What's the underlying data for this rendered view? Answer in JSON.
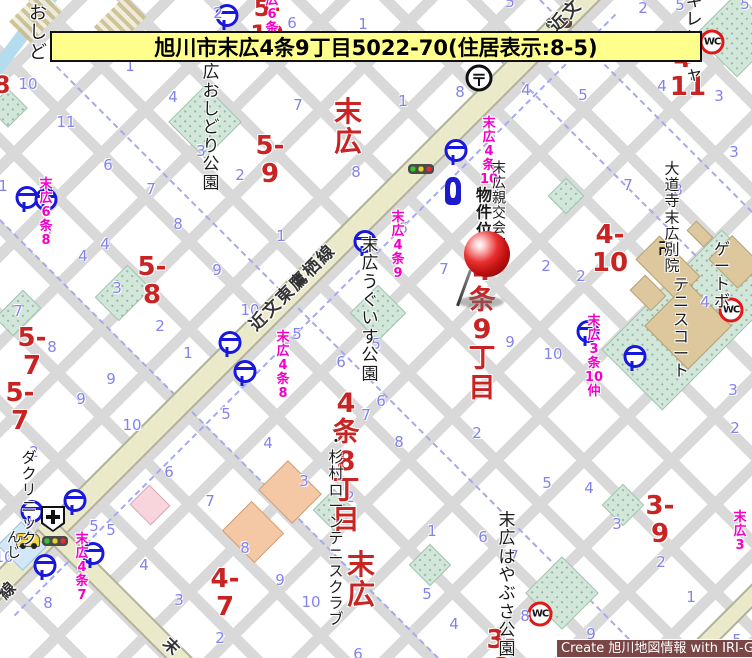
{
  "banner": {
    "title": "旭川市末広4条9丁目5022-70(住居表示:8-5)"
  },
  "attribution": {
    "text": "Create 旭川地図情報 with IRI-GO"
  },
  "colors": {
    "banner_bg": "#ffff8c",
    "district_red": "#c82424",
    "busstop_magenta": "#f500c8",
    "block_number_blue": "#8383ee",
    "main_road": "#eaeacb",
    "park_green": "#d2e7da",
    "bus_icon_blue": "#1818dd",
    "wc_ring_red": "#e01818",
    "attribution_bg": "#7a4646",
    "pin_red": "#c01010"
  },
  "pin": {
    "label": "物件位置",
    "ball_cx": 487,
    "ball_cy": 254,
    "needle_cx": 464,
    "needle_cy": 288,
    "shadow_cx": 481,
    "shadow_cy": 302
  },
  "roads": [
    {
      "n": "road-kinbun-higashitakasu",
      "cx": 292,
      "cy": 292,
      "len": 880,
      "w": 24,
      "rot": -45
    },
    {
      "n": "road-branch-south",
      "cx": 118,
      "cy": 597,
      "len": 210,
      "w": 20,
      "rot": 45
    },
    {
      "n": "road-bottom-right",
      "cx": 720,
      "cy": 628,
      "len": 130,
      "w": 18,
      "rot": -45
    }
  ],
  "water": [
    {
      "n": "river",
      "cx": 25,
      "cy": 32,
      "len": 100,
      "w": 13,
      "rot": -53
    }
  ],
  "hatches": [
    {
      "cx": 36,
      "cy": 16,
      "w": 30,
      "h": 46,
      "rot": 45
    },
    {
      "cx": 120,
      "cy": 22,
      "w": 30,
      "h": 44,
      "rot": 45
    }
  ],
  "dashes": [
    {
      "cx": 350,
      "cy": 360,
      "len": 830,
      "rot": 45
    },
    {
      "cx": 616,
      "cy": 176,
      "len": 385,
      "rot": 45
    },
    {
      "cx": 219,
      "cy": 439,
      "len": 620,
      "rot": 45
    },
    {
      "cx": 646,
      "cy": 106,
      "len": 300,
      "rot": 45
    },
    {
      "cx": 315,
      "cy": 315,
      "len": 850,
      "rot": -45
    }
  ],
  "parks": [
    {
      "n": "park-oshidori",
      "cx": 205,
      "cy": 122,
      "w": 52,
      "h": 52
    },
    {
      "n": "park-uguisu",
      "cx": 378,
      "cy": 313,
      "w": 40,
      "h": 40
    },
    {
      "n": "park-hayabusa",
      "cx": 562,
      "cy": 593,
      "w": 52,
      "h": 52
    },
    {
      "n": "park-kirenja",
      "cx": 737,
      "cy": 35,
      "w": 60,
      "h": 60
    },
    {
      "n": "tennis-court-area",
      "cx": 692,
      "cy": 320,
      "w": 86,
      "h": 170
    },
    {
      "n": "green-block",
      "cx": 18,
      "cy": 313,
      "w": 26,
      "h": 40
    },
    {
      "n": "green-block",
      "cx": 123,
      "cy": 293,
      "w": 34,
      "h": 46
    },
    {
      "n": "green-block",
      "cx": 334,
      "cy": 510,
      "w": 30,
      "h": 30
    },
    {
      "n": "green-block",
      "cx": 430,
      "cy": 565,
      "w": 30,
      "h": 30
    },
    {
      "n": "green-block",
      "cx": 623,
      "cy": 505,
      "w": 30,
      "h": 30
    },
    {
      "n": "green-block",
      "cx": 566,
      "cy": 196,
      "w": 26,
      "h": 26
    },
    {
      "n": "green-block",
      "cx": 8,
      "cy": 108,
      "w": 28,
      "h": 28
    }
  ],
  "buildings": [
    {
      "n": "temple-building",
      "cx": 668,
      "cy": 268,
      "w": 58,
      "h": 34,
      "c": "tan"
    },
    {
      "n": "temple-building",
      "cx": 648,
      "cy": 293,
      "w": 30,
      "h": 22,
      "c": "tan"
    },
    {
      "n": "building",
      "cx": 700,
      "cy": 234,
      "w": 24,
      "h": 14,
      "c": "tan"
    },
    {
      "n": "tennis-court",
      "cx": 688,
      "cy": 326,
      "w": 62,
      "h": 62,
      "c": "tan"
    },
    {
      "n": "tennis-court",
      "cx": 735,
      "cy": 262,
      "w": 42,
      "h": 34,
      "c": "tan"
    },
    {
      "n": "building",
      "cx": 290,
      "cy": 492,
      "w": 48,
      "h": 42,
      "c": "orange"
    },
    {
      "n": "building",
      "cx": 253,
      "cy": 532,
      "w": 46,
      "h": 42,
      "c": "orange"
    },
    {
      "n": "clinic-building",
      "cx": 150,
      "cy": 505,
      "w": 30,
      "h": 28,
      "c": "pink"
    },
    {
      "n": "building",
      "cx": 22,
      "cy": 546,
      "w": 36,
      "h": 34,
      "c": "lblue"
    }
  ],
  "icons": [
    {
      "k": "bus",
      "x": 224,
      "y": 17
    },
    {
      "k": "bus",
      "x": 24,
      "y": 199
    },
    {
      "k": "bus",
      "x": 43,
      "y": 201
    },
    {
      "k": "bus",
      "x": 453,
      "y": 152
    },
    {
      "k": "bus",
      "x": 362,
      "y": 243
    },
    {
      "k": "bus",
      "x": 227,
      "y": 344
    },
    {
      "k": "bus",
      "x": 242,
      "y": 373
    },
    {
      "k": "bus",
      "x": 585,
      "y": 333
    },
    {
      "k": "bus",
      "x": 632,
      "y": 358
    },
    {
      "k": "bus",
      "x": 72,
      "y": 502
    },
    {
      "k": "bus",
      "x": 29,
      "y": 513
    },
    {
      "k": "bus",
      "x": 90,
      "y": 555
    },
    {
      "k": "bus",
      "x": 42,
      "y": 567
    },
    {
      "k": "tl",
      "x": 421,
      "y": 169
    },
    {
      "k": "tl",
      "x": 559,
      "y": 23
    },
    {
      "k": "tl",
      "x": 55,
      "y": 541
    },
    {
      "k": "wc",
      "x": 712,
      "y": 42,
      "t": "WC"
    },
    {
      "k": "wc",
      "x": 731,
      "y": 310,
      "t": "WC"
    },
    {
      "k": "wc",
      "x": 540,
      "y": 614,
      "t": "WC"
    },
    {
      "k": "post",
      "x": 479,
      "y": 78,
      "t": "〒"
    },
    {
      "k": "hosp",
      "x": 53,
      "y": 519
    },
    {
      "k": "temple",
      "x": 666,
      "y": 247,
      "t": "卍"
    },
    {
      "k": "monu",
      "x": 453,
      "y": 191
    },
    {
      "k": "reddot",
      "x": 555,
      "y": 50
    },
    {
      "k": "car",
      "x": 28,
      "y": 540
    }
  ],
  "labels": {
    "red": [
      {
        "text": "5-10",
        "x": 267,
        "y": 22,
        "size": 24
      },
      {
        "text": "8",
        "x": 2,
        "y": 86,
        "size": 24
      },
      {
        "text": "4-11",
        "x": 688,
        "y": 73,
        "size": 26
      },
      {
        "text": "5-9",
        "x": 270,
        "y": 160,
        "size": 26
      },
      {
        "text": "末広",
        "x": 348,
        "y": 127,
        "size": 28
      },
      {
        "text": "4-10",
        "x": 610,
        "y": 249,
        "size": 26
      },
      {
        "text": "4条9丁目",
        "x": 482,
        "y": 330,
        "size": 27
      },
      {
        "text": "5-8",
        "x": 152,
        "y": 281,
        "size": 26
      },
      {
        "text": "5-7",
        "x": 32,
        "y": 352,
        "size": 26
      },
      {
        "text": "5-7",
        "x": 20,
        "y": 407,
        "size": 26
      },
      {
        "text": "4条8丁目",
        "x": 346,
        "y": 462,
        "size": 27
      },
      {
        "text": "4-7",
        "x": 225,
        "y": 593,
        "size": 26
      },
      {
        "text": "末広",
        "x": 361,
        "y": 580,
        "size": 28
      },
      {
        "text": "3-9",
        "x": 660,
        "y": 520,
        "size": 26
      },
      {
        "text": "3-8",
        "x": 501,
        "y": 654,
        "size": 26
      }
    ],
    "magenta": [
      {
        "text": "末広6条10",
        "x": 272,
        "y": 15
      },
      {
        "text": "末広6条8",
        "x": 46,
        "y": 213
      },
      {
        "text": "末広4条10",
        "x": 489,
        "y": 152
      },
      {
        "text": "末広4条9",
        "x": 398,
        "y": 246
      },
      {
        "text": "末広4条8",
        "x": 283,
        "y": 366
      },
      {
        "text": "末広3条\n10仲",
        "x": 594,
        "y": 357
      },
      {
        "text": "末広4条7",
        "x": 82,
        "y": 568
      },
      {
        "text": "末広3",
        "x": 740,
        "y": 532
      }
    ],
    "black": [
      {
        "text": "おしど",
        "x": 38,
        "y": 33,
        "size": 18
      },
      {
        "text": "末広\nおしどり公園",
        "x": 211,
        "y": 119,
        "size": 17
      },
      {
        "text": "末広キレンジャ",
        "x": 694,
        "y": 20,
        "size": 17
      },
      {
        "text": "末広親交会館",
        "x": 499,
        "y": 207,
        "size": 14
      },
      {
        "text": "物件位置",
        "x": 484,
        "y": 221,
        "size": 16,
        "b": 1,
        "n": "property-location-label"
      },
      {
        "text": "大道寺\n末広別院",
        "x": 672,
        "y": 217,
        "size": 15
      },
      {
        "text": "ゲートボ",
        "x": 722,
        "y": 275,
        "size": 16
      },
      {
        "text": "テニスコート",
        "x": 681,
        "y": 328,
        "size": 16
      },
      {
        "text": "末広\nうぐいす公園",
        "x": 370,
        "y": 310,
        "size": 17
      },
      {
        "text": "・杉村ローンテニスクラブ",
        "x": 336,
        "y": 530,
        "size": 15
      },
      {
        "text": "末広\nはやぶさ公園",
        "x": 507,
        "y": 585,
        "size": 17
      },
      {
        "text": "んじ",
        "x": 14,
        "y": 546,
        "size": 14
      },
      {
        "text": "ダクリニック",
        "x": 29,
        "y": 498,
        "size": 15
      }
    ],
    "rotated": [
      {
        "text": "近文東鷹栖線",
        "x": 293,
        "y": 288,
        "size": 17,
        "rot": -45,
        "n": "road-name-label"
      },
      {
        "text": "近文",
        "x": 566,
        "y": 16,
        "size": 17,
        "rot": -45,
        "n": "road-name-label"
      },
      {
        "text": "線",
        "x": 8,
        "y": 590,
        "size": 16,
        "rot": -45,
        "n": "road-name-label"
      },
      {
        "text": "末",
        "x": 172,
        "y": 647,
        "size": 16,
        "rot": 45,
        "n": "road-name-label"
      }
    ],
    "blue_numbers": [
      {
        "t": "5",
        "x": 263,
        "y": 3
      },
      {
        "t": "2",
        "x": 218,
        "y": 13
      },
      {
        "t": "6",
        "x": 292,
        "y": 23
      },
      {
        "t": "1",
        "x": 363,
        "y": 24
      },
      {
        "t": "5",
        "x": 510,
        "y": 2
      },
      {
        "t": "2",
        "x": 643,
        "y": 8
      },
      {
        "t": "5",
        "x": 680,
        "y": 5
      },
      {
        "t": "5",
        "x": 745,
        "y": 4
      },
      {
        "t": "1",
        "x": 130,
        "y": 66
      },
      {
        "t": "10",
        "x": 28,
        "y": 84
      },
      {
        "t": "11",
        "x": 66,
        "y": 122
      },
      {
        "t": "4",
        "x": 173,
        "y": 97
      },
      {
        "t": "3",
        "x": 201,
        "y": 151
      },
      {
        "t": "2",
        "x": 240,
        "y": 175
      },
      {
        "t": "6",
        "x": 108,
        "y": 165
      },
      {
        "t": "7",
        "x": 151,
        "y": 189
      },
      {
        "t": "8",
        "x": 178,
        "y": 224
      },
      {
        "t": "5",
        "x": 47,
        "y": 231
      },
      {
        "t": "1",
        "x": 3,
        "y": 186
      },
      {
        "t": "4",
        "x": 105,
        "y": 244
      },
      {
        "t": "4",
        "x": 83,
        "y": 256
      },
      {
        "t": "7",
        "x": 298,
        "y": 105
      },
      {
        "t": "1",
        "x": 403,
        "y": 101
      },
      {
        "t": "8",
        "x": 356,
        "y": 172
      },
      {
        "t": "8",
        "x": 460,
        "y": 92
      },
      {
        "t": "4",
        "x": 526,
        "y": 90
      },
      {
        "t": "5",
        "x": 583,
        "y": 95
      },
      {
        "t": "4",
        "x": 662,
        "y": 86
      },
      {
        "t": "3",
        "x": 719,
        "y": 96
      },
      {
        "t": "3",
        "x": 495,
        "y": 192
      },
      {
        "t": "7",
        "x": 628,
        "y": 185
      },
      {
        "t": "8",
        "x": 678,
        "y": 190
      },
      {
        "t": "2",
        "x": 546,
        "y": 266
      },
      {
        "t": "2",
        "x": 581,
        "y": 276
      },
      {
        "t": "7",
        "x": 444,
        "y": 269
      },
      {
        "t": "6",
        "x": 403,
        "y": 228
      },
      {
        "t": "1",
        "x": 281,
        "y": 236
      },
      {
        "t": "9",
        "x": 217,
        "y": 270
      },
      {
        "t": "10",
        "x": 250,
        "y": 310
      },
      {
        "t": "5",
        "x": 297,
        "y": 334
      },
      {
        "t": "6",
        "x": 341,
        "y": 362
      },
      {
        "t": "5",
        "x": 376,
        "y": 344
      },
      {
        "t": "6",
        "x": 381,
        "y": 401
      },
      {
        "t": "1",
        "x": 188,
        "y": 353
      },
      {
        "t": "5",
        "x": 226,
        "y": 414
      },
      {
        "t": "7",
        "x": 366,
        "y": 415
      },
      {
        "t": "9",
        "x": 510,
        "y": 342
      },
      {
        "t": "10",
        "x": 553,
        "y": 354
      },
      {
        "t": "7",
        "x": 18,
        "y": 311
      },
      {
        "t": "3",
        "x": 117,
        "y": 288
      },
      {
        "t": "2",
        "x": 160,
        "y": 326
      },
      {
        "t": "8",
        "x": 52,
        "y": 347
      },
      {
        "t": "9",
        "x": 111,
        "y": 379
      },
      {
        "t": "9",
        "x": 81,
        "y": 399
      },
      {
        "t": "10",
        "x": 132,
        "y": 425
      },
      {
        "t": "2",
        "x": 34,
        "y": 452
      },
      {
        "t": "6",
        "x": 169,
        "y": 472
      },
      {
        "t": "7",
        "x": 210,
        "y": 501
      },
      {
        "t": "5",
        "x": 111,
        "y": 530
      },
      {
        "t": "5",
        "x": 94,
        "y": 526
      },
      {
        "t": "4",
        "x": 144,
        "y": 565
      },
      {
        "t": "3",
        "x": 179,
        "y": 600
      },
      {
        "t": "8",
        "x": 48,
        "y": 603
      },
      {
        "t": "10",
        "x": 4,
        "y": 557
      },
      {
        "t": "2",
        "x": 220,
        "y": 638
      },
      {
        "t": "4",
        "x": 268,
        "y": 443
      },
      {
        "t": "8",
        "x": 399,
        "y": 442
      },
      {
        "t": "3",
        "x": 304,
        "y": 481
      },
      {
        "t": "2",
        "x": 350,
        "y": 497
      },
      {
        "t": "1",
        "x": 432,
        "y": 531
      },
      {
        "t": "8",
        "x": 245,
        "y": 548
      },
      {
        "t": "9",
        "x": 280,
        "y": 580
      },
      {
        "t": "10",
        "x": 311,
        "y": 602
      },
      {
        "t": "6",
        "x": 483,
        "y": 537
      },
      {
        "t": "5",
        "x": 427,
        "y": 594
      },
      {
        "t": "2",
        "x": 477,
        "y": 433
      },
      {
        "t": "5",
        "x": 547,
        "y": 483
      },
      {
        "t": "4",
        "x": 589,
        "y": 488
      },
      {
        "t": "3",
        "x": 617,
        "y": 524
      },
      {
        "t": "7",
        "x": 514,
        "y": 556
      },
      {
        "t": "2",
        "x": 661,
        "y": 562
      },
      {
        "t": "1",
        "x": 691,
        "y": 597
      },
      {
        "t": "8",
        "x": 525,
        "y": 616
      },
      {
        "t": "9",
        "x": 591,
        "y": 634
      },
      {
        "t": "4",
        "x": 454,
        "y": 624
      },
      {
        "t": "6",
        "x": 358,
        "y": 654
      },
      {
        "t": "4",
        "x": 705,
        "y": 302
      },
      {
        "t": "3",
        "x": 733,
        "y": 390
      },
      {
        "t": "2",
        "x": 735,
        "y": 428
      },
      {
        "t": "5",
        "x": 737,
        "y": 640
      },
      {
        "t": "3",
        "x": 734,
        "y": 152
      }
    ]
  }
}
